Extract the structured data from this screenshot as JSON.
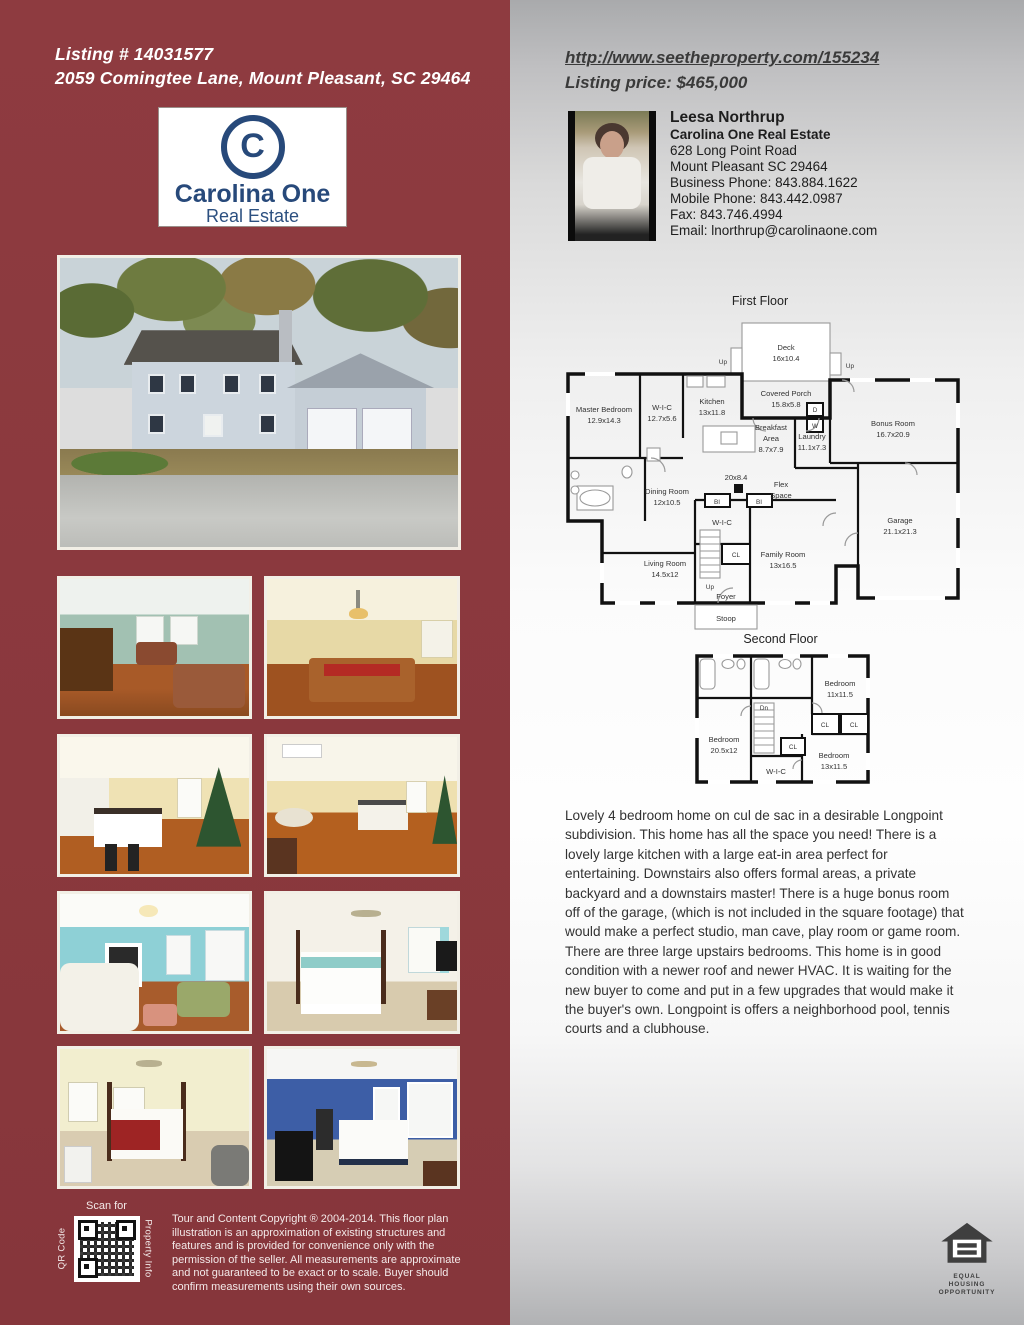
{
  "colors": {
    "maroon": "#8a383d",
    "navy": "#27497a",
    "frame": "#f2efe6",
    "panel_gray": "#c9c9cb"
  },
  "header": {
    "listing_number": "Listing # 14031577",
    "address": "2059 Comingtee Lane, Mount Pleasant, SC 29464"
  },
  "logo": {
    "symbol": "C",
    "name": "Carolina One",
    "subtitle": "Real Estate"
  },
  "right_header": {
    "url": "http://www.seetheproperty.com/155234",
    "price": "Listing price: $465,000"
  },
  "agent": {
    "name": "Leesa Northrup",
    "company": "Carolina One Real Estate",
    "address1": "628 Long Point Road",
    "address2": "Mount Pleasant SC 29464",
    "business_phone": "Business Phone: 843.884.1622",
    "mobile_phone": "Mobile Phone: 843.442.0987",
    "fax": "Fax: 843.746.4994",
    "email": "Email: lnorthrup@carolinaone.com"
  },
  "fp1": {
    "title": "First Floor",
    "deck1": "Deck",
    "deck2": "16x10.4",
    "up": "Up",
    "porch1": "Covered Porch",
    "porch2": "15.8x5.8",
    "master1": "Master Bedroom",
    "master2": "12.9x14.3",
    "wic_a1": "W-I-C",
    "wic_a2": "12.7x5.6",
    "kitchen1": "Kitchen",
    "kitchen2": "13x11.8",
    "breakfast1": "Breakfast",
    "breakfast2": "Area",
    "breakfast3": "8.7x7.9",
    "laundry1": "Laundry",
    "laundry2": "11.1x7.3",
    "d": "D",
    "w": "W",
    "bonus1": "Bonus Room",
    "bonus2": "16.7x20.9",
    "hall": "20x8.4",
    "flex1": "Flex",
    "flex2": "Space",
    "dining1": "Dining Room",
    "dining2": "12x10.5",
    "bi": "BI",
    "wic_b": "W-I-C",
    "cl": "CL",
    "family1": "Family Room",
    "family2": "13x16.5",
    "garage1": "Garage",
    "garage2": "21.1x21.3",
    "living1": "Living Room",
    "living2": "14.5x12",
    "foyer": "Foyer",
    "stoop": "Stoop"
  },
  "fp2": {
    "title": "Second Floor",
    "bed1_1": "Bedroom",
    "bed1_2": "11x11.5",
    "bed2_1": "Bedroom",
    "bed2_2": "20.5x12",
    "bed3_1": "Bedroom",
    "bed3_2": "13x11.5",
    "cl": "CL",
    "dn": "Dn",
    "wic": "W-I-C"
  },
  "description": "Lovely 4 bedroom home on cul de sac in a desirable Longpoint subdivision. This home has all the space you need! There is a lovely large kitchen with a large eat-in area perfect for entertaining. Downstairs also offers formal areas, a private backyard and a downstairs master! There is a huge bonus room off of the garage, (which is not included in the square footage) that would make a perfect studio, man cave, play room or game room. There are three large upstairs bedrooms. This home is in good condition with a newer roof and newer HVAC. It is waiting for the new buyer to come and put in a few upgrades that would make it the buyer's own. Longpoint is offers a neighborhood pool, tennis courts and a clubhouse.",
  "qr": {
    "scan_for": "Scan for",
    "left_label": "QR Code",
    "right_label": "Property Info"
  },
  "copyright": "Tour and Content Copyright ® 2004-2014. This floor plan illustration is an approximation of existing structures and features and is provided for convenience only with the permission of the seller. All measurements are approximate and not guaranteed to be exact or to scale. Buyer should confirm measurements using their own sources.",
  "eho": {
    "line1": "EQUAL HOUSING",
    "line2": "OPPORTUNITY"
  },
  "photos": {
    "main": "front-exterior",
    "grid": [
      "living-room-piano",
      "dining-room",
      "kitchen-island",
      "kitchen-open",
      "sitting-room-aqua",
      "master-bedroom",
      "bedroom-four-poster",
      "bedroom-blue"
    ]
  }
}
